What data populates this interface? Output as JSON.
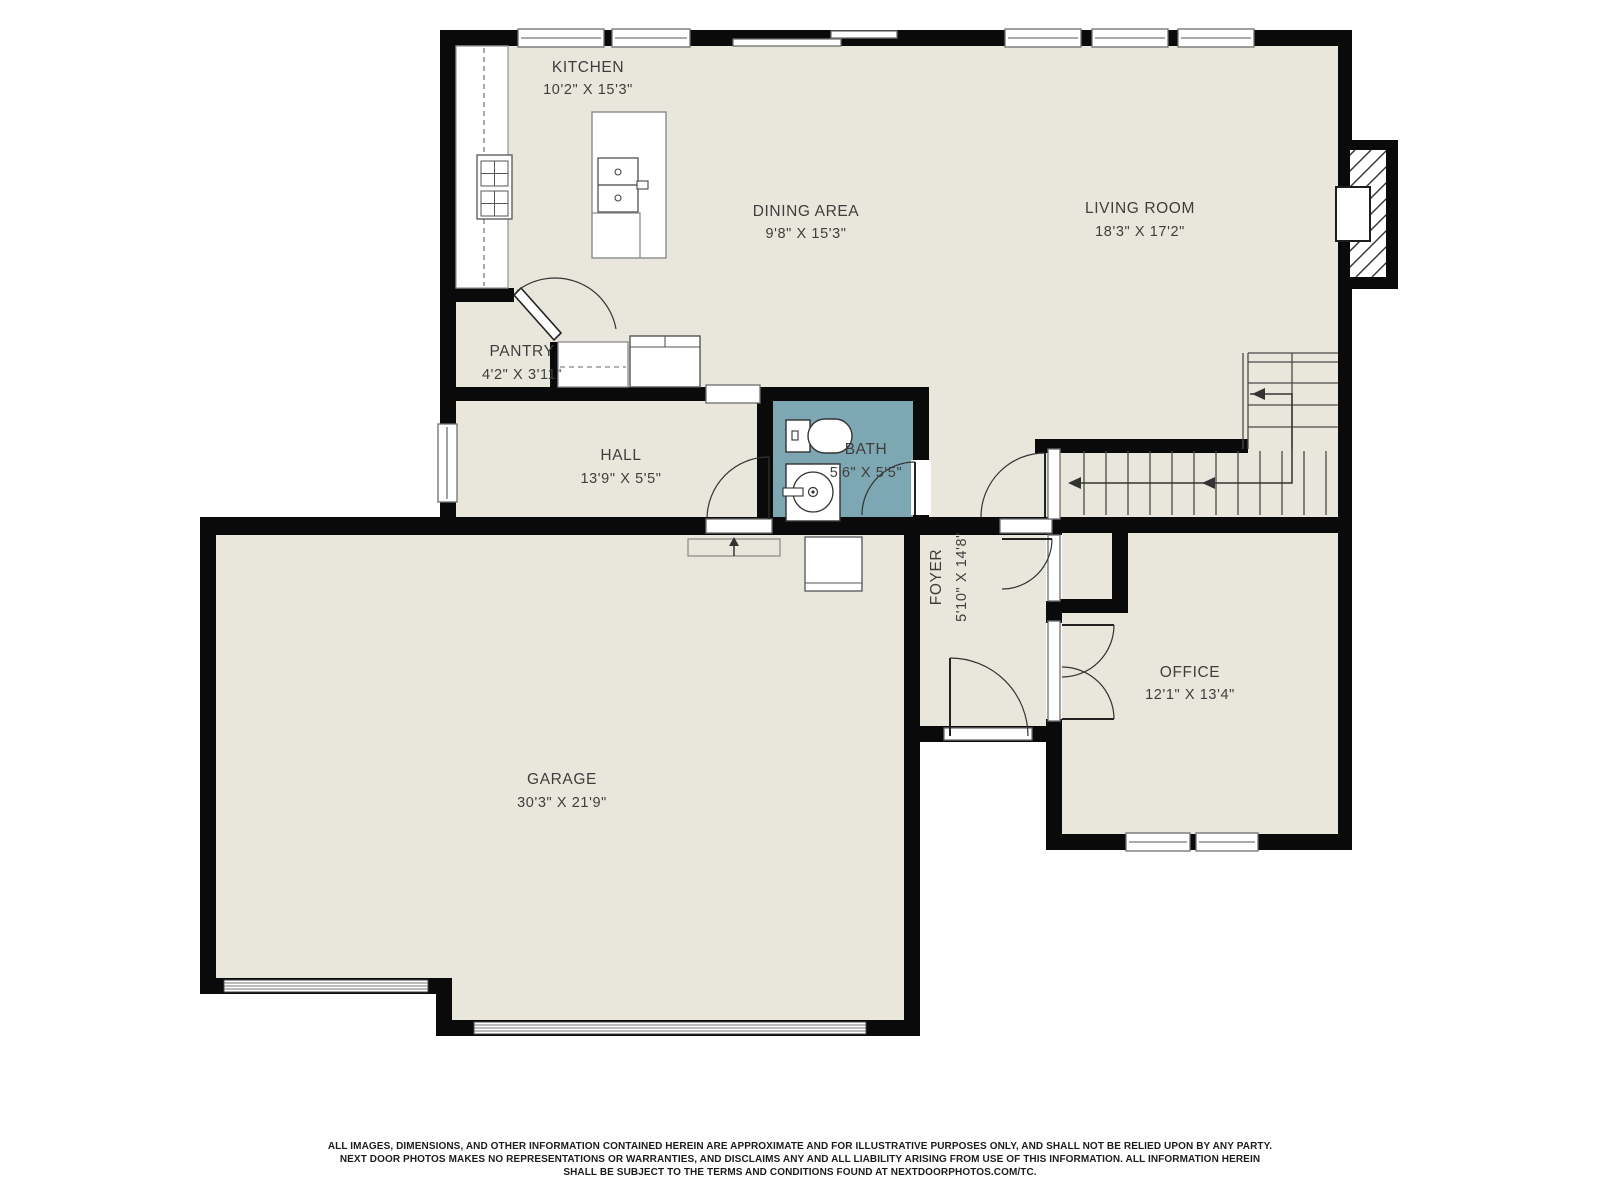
{
  "rooms": [
    {
      "name": "KITCHEN",
      "dims": "10'2\" X 15'3\""
    },
    {
      "name": "DINING AREA",
      "dims": "9'8\" X 15'3\""
    },
    {
      "name": "LIVING ROOM",
      "dims": "18'3\" X 17'2\""
    },
    {
      "name": "PANTRY",
      "dims": "4'2\" X 3'11\""
    },
    {
      "name": "HALL",
      "dims": "13'9\" X 5'5\""
    },
    {
      "name": "BATH",
      "dims": "5'6\" X 5'5\""
    },
    {
      "name": "FOYER",
      "dims": "5'10\" X 14'8\""
    },
    {
      "name": "OFFICE",
      "dims": "12'1\" X 13'4\""
    },
    {
      "name": "GARAGE",
      "dims": "30'3\" X 21'9\""
    }
  ],
  "colors": {
    "floor": "#e9e7db",
    "wall": "#0a0a0a",
    "bath": "#7da7b2",
    "fixture": "#3a3a3a",
    "text": "#3e3e3e"
  },
  "disclaimer": {
    "line1": "ALL IMAGES, DIMENSIONS, AND OTHER INFORMATION CONTAINED HEREIN ARE APPROXIMATE AND FOR ILLUSTRATIVE PURPOSES ONLY, AND SHALL NOT BE RELIED UPON BY ANY PARTY.",
    "line2": "NEXT DOOR PHOTOS MAKES NO REPRESENTATIONS OR WARRANTIES, AND DISCLAIMS ANY AND ALL LIABILITY ARISING FROM USE OF THIS INFORMATION. ALL INFORMATION HEREIN",
    "line3": "SHALL BE SUBJECT TO THE TERMS AND CONDITIONS FOUND AT NEXTDOORPHOTOS.COM/TC."
  }
}
